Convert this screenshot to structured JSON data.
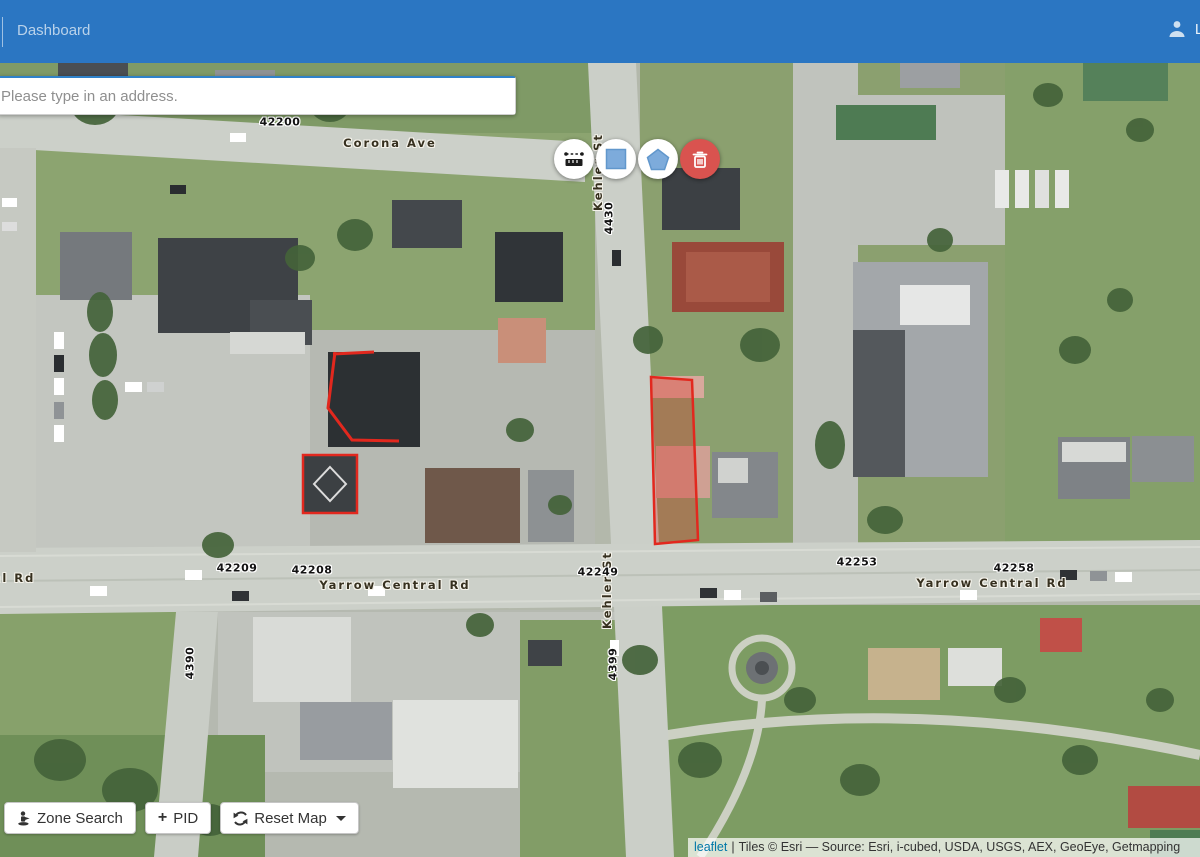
{
  "colors": {
    "header_bg": "#2b76c2",
    "tool_shape_blue": "#7dabdb",
    "danger_red": "#d9534f",
    "parcel_red": "#e2281e",
    "leaflet_link_blue": "#0078a8"
  },
  "header": {
    "title": "Dashboard",
    "user_label": "Liv"
  },
  "search": {
    "placeholder": "Please type in an address."
  },
  "toolbar": {
    "buttons": [
      {
        "name": "measure"
      },
      {
        "name": "draw-rectangle"
      },
      {
        "name": "draw-polygon"
      },
      {
        "name": "delete-shapes"
      }
    ]
  },
  "map_labels": {
    "streets": [
      {
        "text": "Corona Ave"
      },
      {
        "text": "Kehler St"
      },
      {
        "text": "Yarrow Central Rd"
      },
      {
        "text": "Yarrow Central Rd"
      },
      {
        "text": "Kehler St"
      },
      {
        "text": "al Rd"
      }
    ],
    "addresses": [
      {
        "text": "42200"
      },
      {
        "text": "4430"
      },
      {
        "text": "42209"
      },
      {
        "text": "42208"
      },
      {
        "text": "42249"
      },
      {
        "text": "42253"
      },
      {
        "text": "42258"
      },
      {
        "text": "4399"
      },
      {
        "text": "4390"
      }
    ]
  },
  "footer_buttons": {
    "zone_search": "Zone Search",
    "pid": "PID",
    "reset_map": "Reset Map"
  },
  "attribution": {
    "leaflet": "leaflet",
    "separator": "|",
    "tiles": "Tiles © Esri — Source: Esri, i-cubed, USDA, USGS, AEX, GeoEye, Getmapping"
  }
}
